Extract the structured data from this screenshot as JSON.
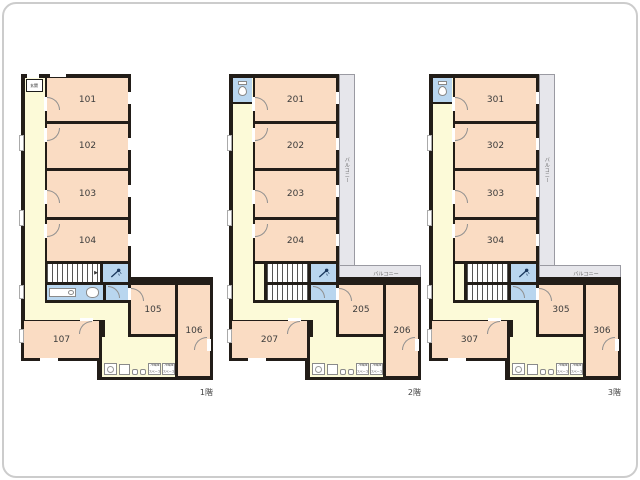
{
  "colors": {
    "wall": "#221d18",
    "room": "#fadcc3",
    "corridor": "#fcfad8",
    "wet": "#b9d6ef",
    "balcony": "#e6e6eb"
  },
  "floors": [
    {
      "label": "1階",
      "entrance": "玄関",
      "rooms": {
        "r1": "101",
        "r2": "102",
        "r3": "103",
        "r4": "104",
        "r5": "105",
        "r6": "106",
        "r7": "107"
      },
      "kitchen": {
        "fridge_line1": "冷蔵庫",
        "fridge_line2": "スペース"
      }
    },
    {
      "label": "2階",
      "balcony_side": "バルコニー",
      "balcony_bottom": "バルコニー",
      "rooms": {
        "r1": "201",
        "r2": "202",
        "r3": "203",
        "r4": "204",
        "r5": "205",
        "r6": "206",
        "r7": "207"
      },
      "kitchen": {
        "fridge_line1": "冷蔵庫",
        "fridge_line2": "スペース"
      }
    },
    {
      "label": "3階",
      "balcony_side": "バルコニー",
      "balcony_bottom": "バルコニー",
      "rooms": {
        "r1": "301",
        "r2": "302",
        "r3": "303",
        "r4": "304",
        "r5": "305",
        "r6": "306",
        "r7": "307"
      },
      "kitchen": {
        "fridge_line1": "冷蔵庫",
        "fridge_line2": "スペース"
      }
    }
  ]
}
